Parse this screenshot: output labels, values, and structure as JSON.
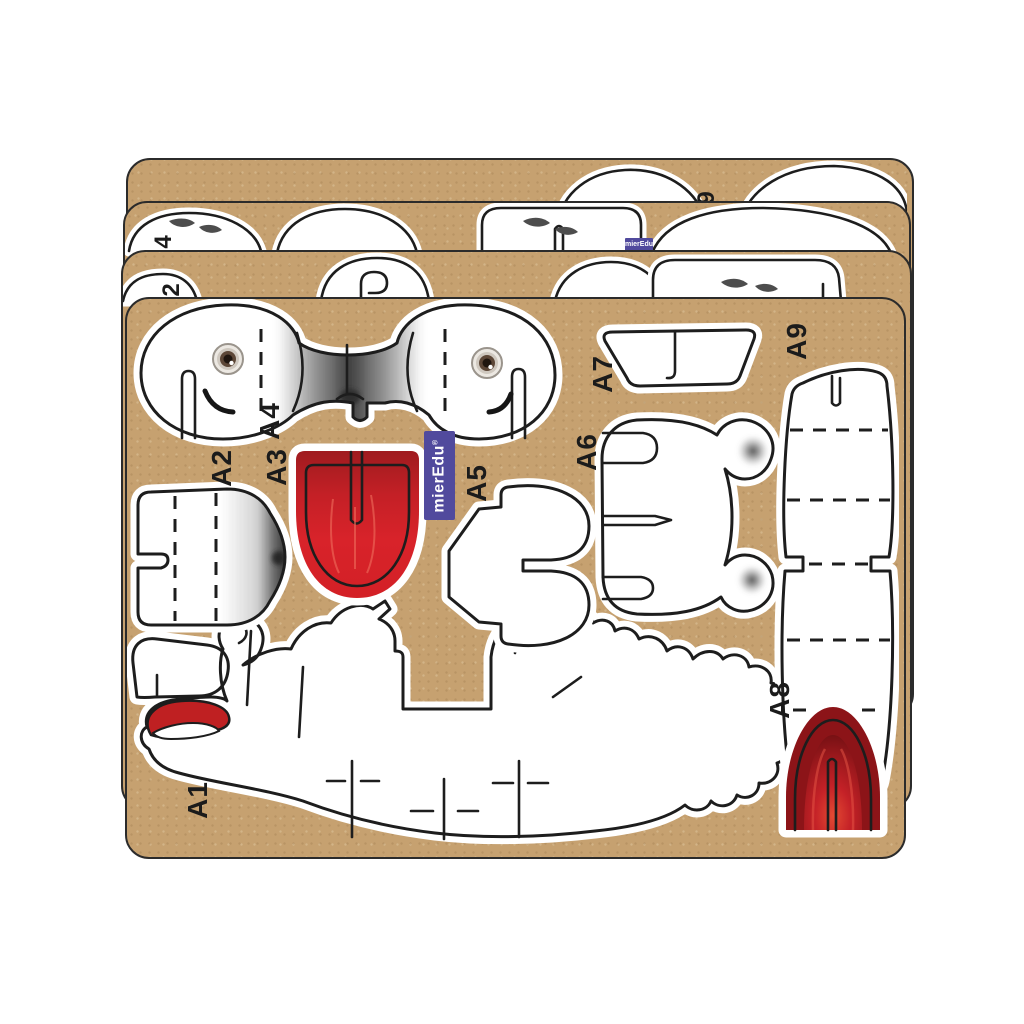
{
  "brand": {
    "name": "mierEdu",
    "reg": "®"
  },
  "front_sheet": {
    "piece_labels": {
      "A1": "A1",
      "A2": "A2",
      "A3": "A3",
      "A4": "A4",
      "A5": "A5",
      "A6": "A6",
      "A7": "A7",
      "A8": "A8",
      "A9": "A9"
    }
  },
  "back_sheets": {
    "sheet1": {
      "partial_label": "9"
    },
    "sheet2": {
      "partial_label": "4"
    },
    "sheet3": {
      "partial_label": "2"
    }
  },
  "colors": {
    "background": "#ffffff",
    "cardboard": "#c6a170",
    "die_line": "#1d1d1d",
    "piece_white": "#ffffff",
    "tongue_red": "#d8232a",
    "dark_red": "#8c1418",
    "logo_purple": "#514a9d",
    "fur_gray": "#5a5a5a"
  }
}
